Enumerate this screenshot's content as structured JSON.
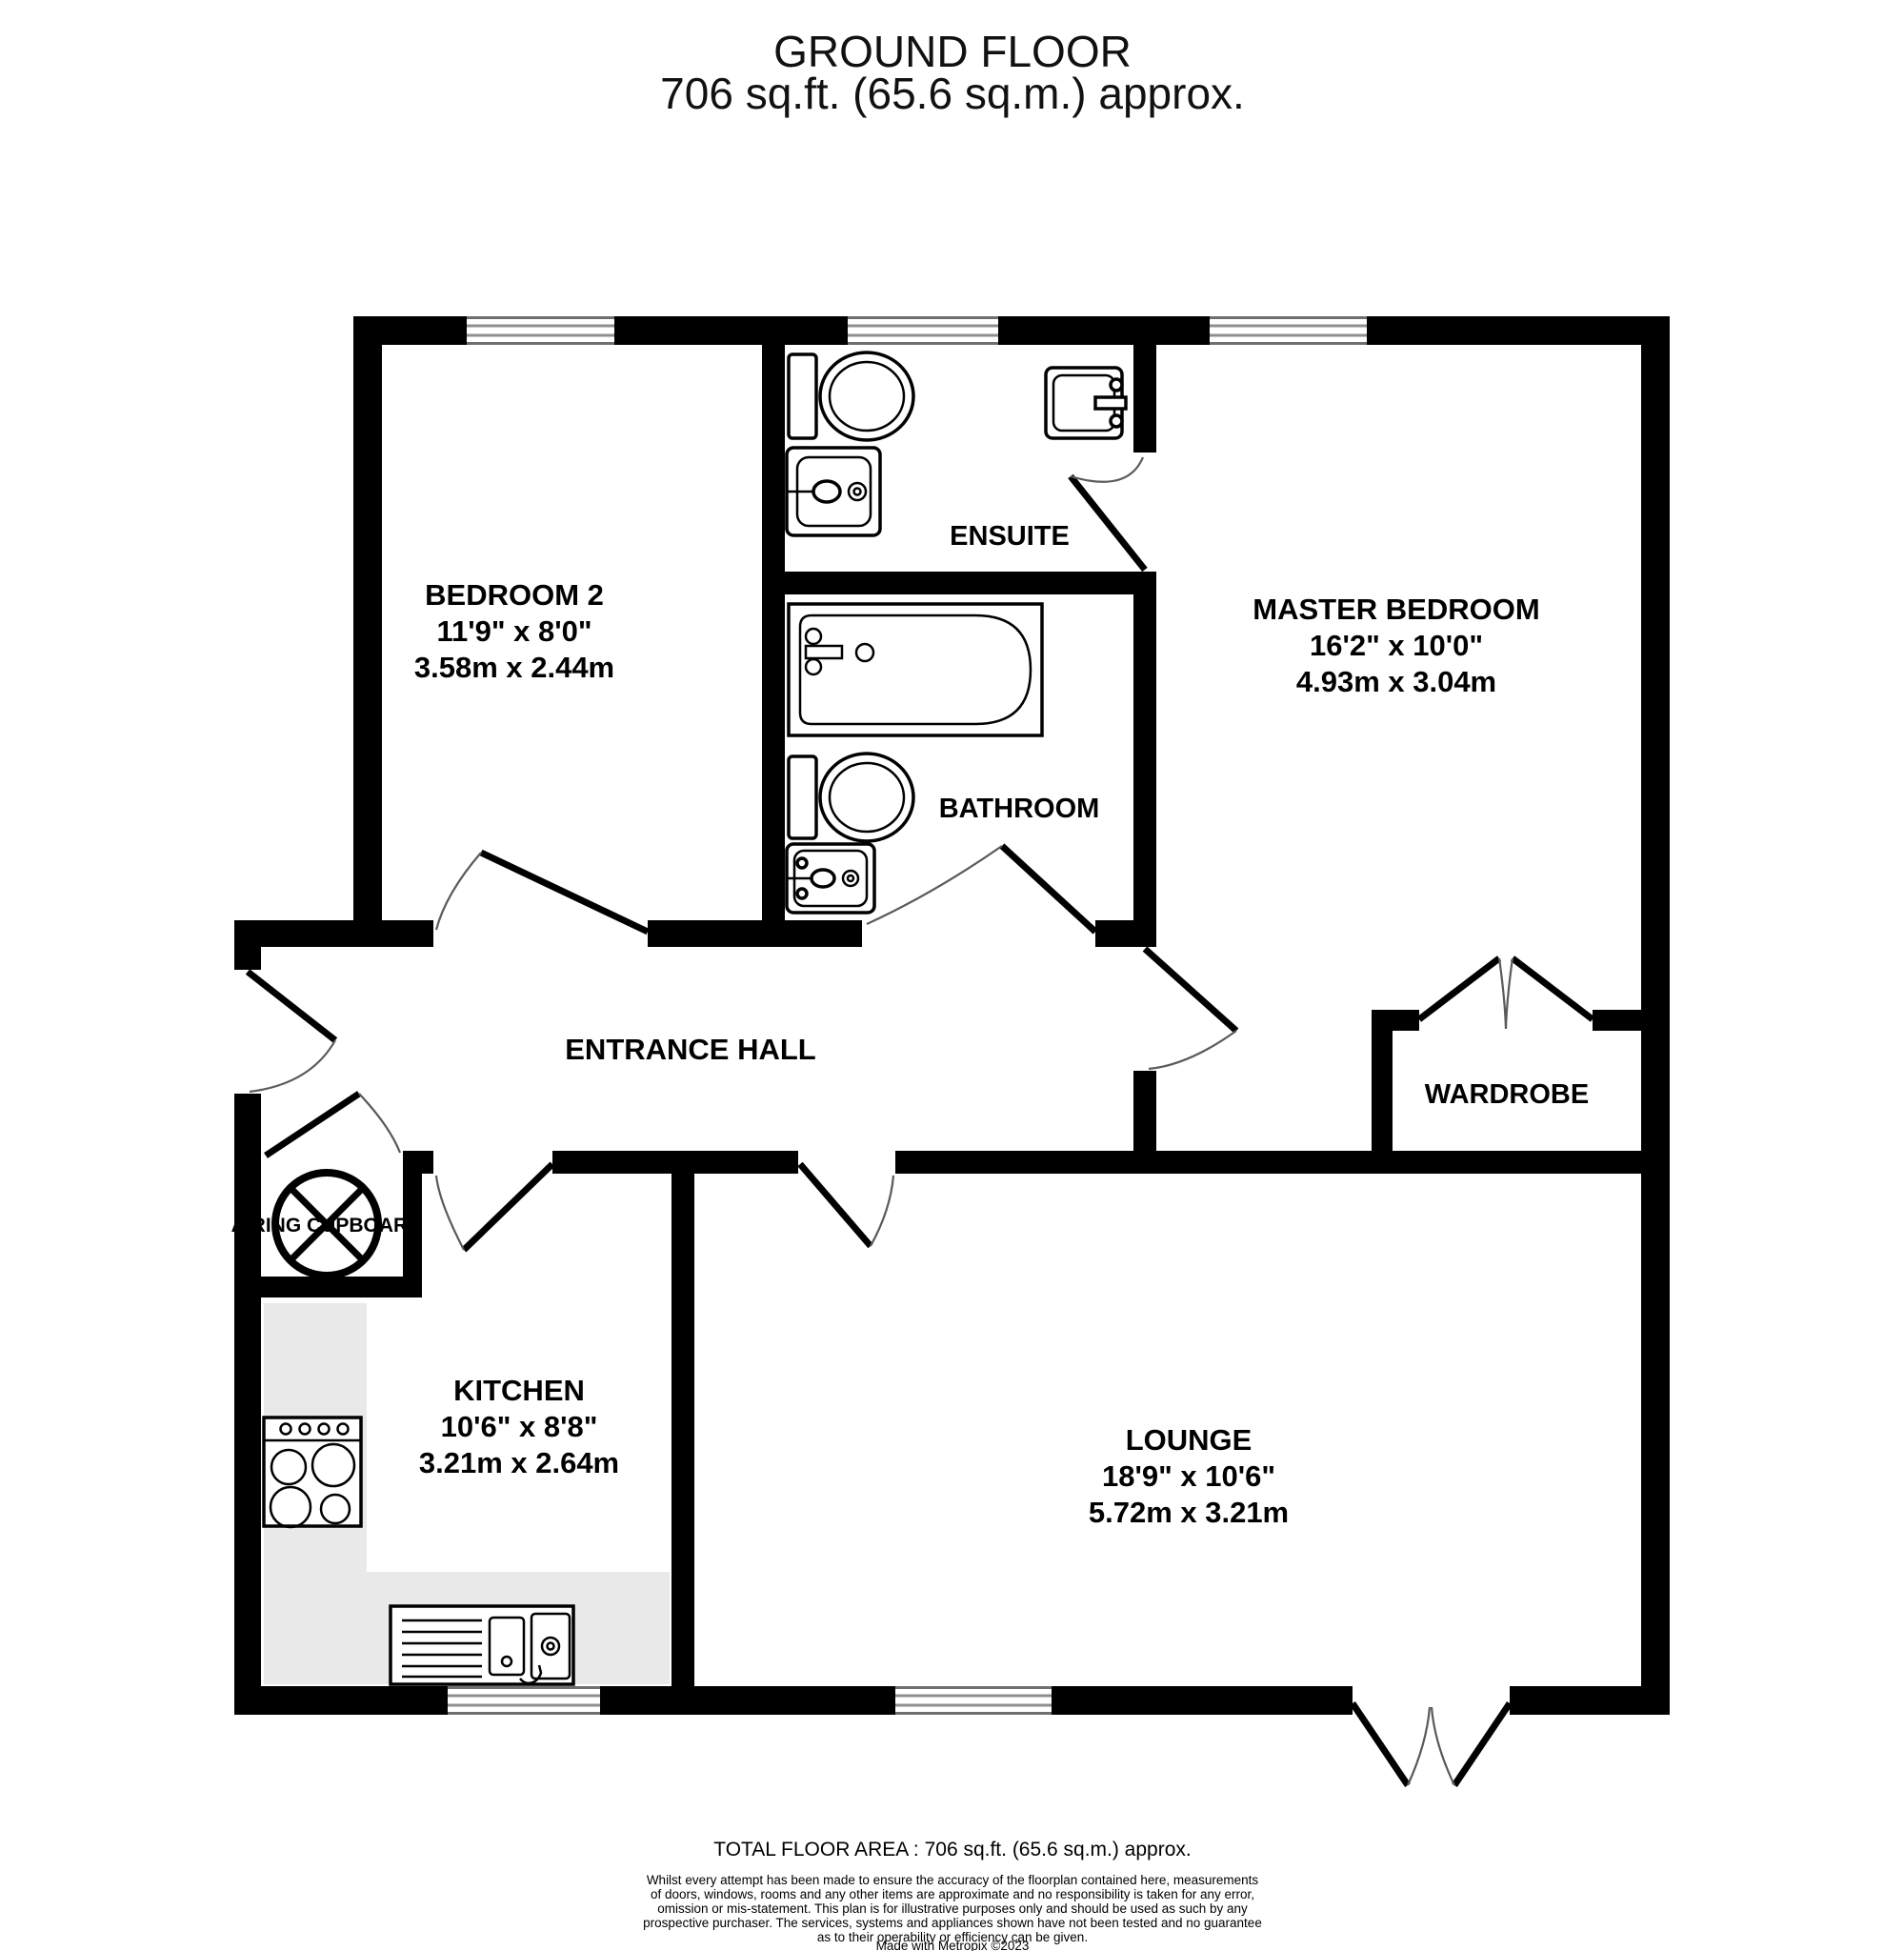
{
  "title": {
    "line1": "GROUND FLOOR",
    "line2": "706 sq.ft. (65.6 sq.m.) approx."
  },
  "rooms": {
    "bedroom2": {
      "name": "BEDROOM 2",
      "imperial": "11'9\"  x 8'0\"",
      "metric": "3.58m  x 2.44m"
    },
    "master": {
      "name": "MASTER BEDROOM",
      "imperial": "16'2\"  x 10'0\"",
      "metric": "4.93m  x 3.04m"
    },
    "ensuite": {
      "name": "ENSUITE"
    },
    "bathroom": {
      "name": "BATHROOM"
    },
    "hall": {
      "name": "ENTRANCE HALL"
    },
    "wardrobe": {
      "name": "WARDROBE"
    },
    "cupboard": {
      "name": "AIRING CUPBOARD"
    },
    "kitchen": {
      "name": "KITCHEN",
      "imperial": "10'6\"  x 8'8\"",
      "metric": "3.21m  x 2.64m"
    },
    "lounge": {
      "name": "LOUNGE",
      "imperial": "18'9\"  x 10'6\"",
      "metric": "5.72m  x 3.21m"
    }
  },
  "fixtures": {
    "ensuite": [
      "toilet-icon",
      "sink-icon",
      "sink-icon"
    ],
    "bathroom": [
      "bathtub-icon",
      "toilet-icon",
      "sink-icon"
    ],
    "kitchen": [
      "stove-icon",
      "kitchen-sink-drainer-icon",
      "worktop-counter"
    ],
    "cupboard": [
      "hot-water-cylinder-icon"
    ]
  },
  "colors": {
    "wall": "#000000",
    "window_frame": "#8f8f8f",
    "counter": "#e9e9e9",
    "door_arc": "#5a5a5a"
  },
  "footer": {
    "total": "TOTAL FLOOR AREA : 706 sq.ft. (65.6 sq.m.) approx.",
    "disclaimer": [
      "Whilst every attempt has been made to ensure the accuracy of the floorplan contained here, measurements",
      "of doors, windows, rooms and any other items are approximate and no responsibility is taken for any error,",
      "omission or mis-statement. This plan is for illustrative purposes only and should be used as such by any",
      "prospective purchaser. The services, systems and appliances shown have not been tested and no guarantee",
      "as to their operability or efficiency can be given."
    ],
    "credit": "Made with Metropix ©2023"
  }
}
